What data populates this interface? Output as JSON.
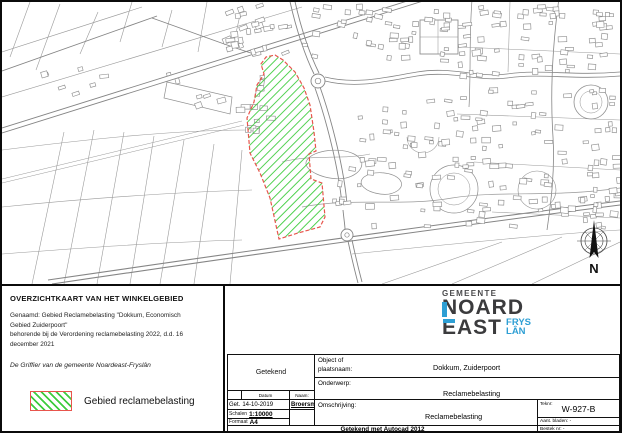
{
  "map": {
    "compass_n": "N",
    "colors": {
      "line": "#8f8f8f",
      "hatch_green": "#3ecc3e",
      "boundary_red": "#e8554d"
    }
  },
  "info_box": {
    "title": "OVERZICHTKAART VAN HET WINKELGEBIED",
    "description_lines": [
      "Genaamd: Gebied Reclamebelasting \"Dokkum, Economisch",
      "Gebied Zuiderpoort\"",
      "behorende bij de Verordening reclamebelasting 2022, d.d. 16",
      "december 2021"
    ],
    "griffier_line": "De Griffier van de gemeente Noardeast-Fryslân",
    "legend": {
      "label": "Gebied reclamebelasting"
    }
  },
  "title_block": {
    "logo": {
      "gemeente": "GEMEENTE",
      "word1": "NOARD",
      "word2": "EAST",
      "word3": "FRYS",
      "word4": "LÂN",
      "accent_blue": "#2e9fd4",
      "dark": "#3b3b3d"
    },
    "getekend_label": "Getekend",
    "columns": {
      "get": "Get.",
      "datum": "Datum",
      "naam": "Naam:"
    },
    "row": {
      "prefix": "Get.",
      "datum": "14-10-2019",
      "naam": "Broersma"
    },
    "schalen_label": "Schalen",
    "schalen_value": "1:10000",
    "formaat_label": "Formaat",
    "formaat_value": "A4",
    "autocad_note": "Getekend met Autocad 2012",
    "object_label": "Object of plaatsnaam:",
    "object_value": "Dokkum, Zuiderpoort",
    "onderwerp_label": "Onderwerp:",
    "onderwerp_value": "Reclamebelasting",
    "omschrijving_label": "Omschrijving:",
    "omschrijving_value": "Reclamebelasting",
    "teknr_label": "Teknr:",
    "teknr_value": "W-927-B",
    "aant_bladen_label": "Aant. bladen: -",
    "bestek_label": "Bestek nr: -"
  }
}
